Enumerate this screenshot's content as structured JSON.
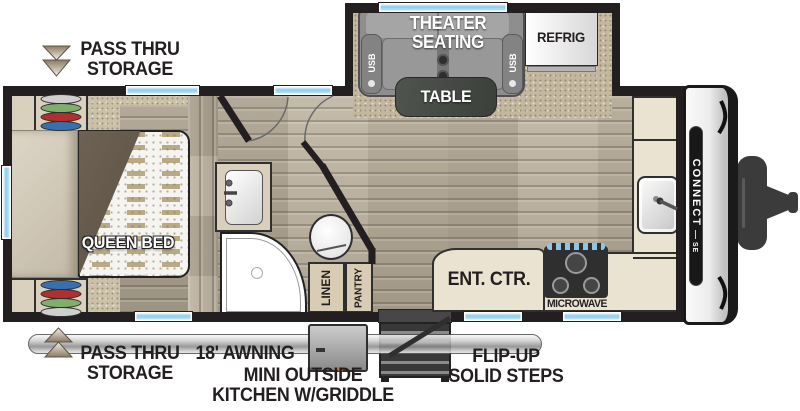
{
  "title": "Travel trailer floor plan",
  "labels": {
    "pass_thru_top": [
      "PASS THRU",
      "STORAGE"
    ],
    "pass_thru_bottom": [
      "PASS THRU",
      "STORAGE"
    ],
    "awning": "18' AWNING",
    "outside_kitchen": [
      "MINI OUTSIDE",
      "KITCHEN W/GRIDDLE"
    ],
    "steps": [
      "FLIP-UP",
      "SOLID STEPS"
    ],
    "theater_seating": [
      "THEATER",
      "SEATING"
    ],
    "usb": "USB",
    "table": "TABLE",
    "refrigerator": "REFRIG",
    "queen_bed": "QUEEN BED",
    "linen": "LINEN",
    "pantry": "PANTRY",
    "ent_ctr": "ENT. CTR.",
    "microwave": "MICROWAVE",
    "brand": "CONNECT",
    "brand_sub": "SE"
  },
  "colors": {
    "wall": "#231f20",
    "window_blue": "#8fcdec",
    "carpet": "#cbc1a9",
    "wood": "#b3a894",
    "counter": "#ebe3d2",
    "sofa_gray": "#8e8e8e",
    "table_wood": "#474c46",
    "awning_gray": "#c7c7c7",
    "igniter_orange": "#d86a1a",
    "hanger_colors": [
      "#cfcfcf",
      "#7fae6d",
      "#b03030",
      "#3a6fae"
    ]
  }
}
